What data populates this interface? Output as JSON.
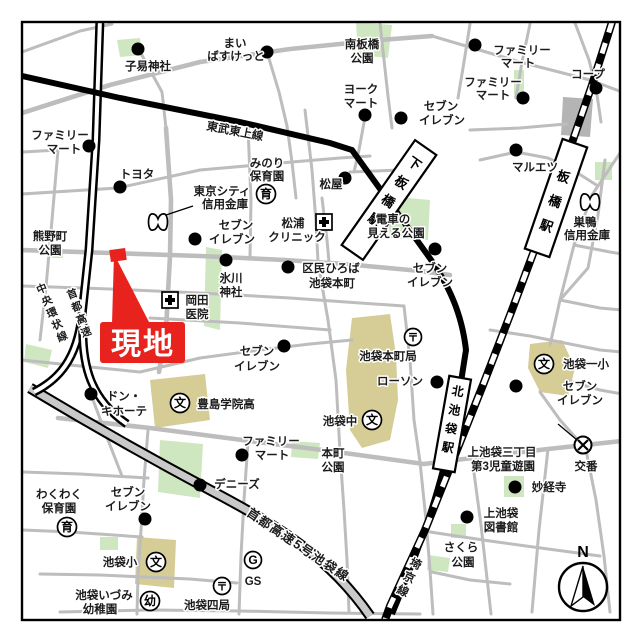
{
  "map": {
    "site_label": "現地",
    "compass_north": "N"
  },
  "railways": {
    "tobu_tojo": "東武東上線",
    "saikyo": "埼京線",
    "shuto5": "首都高速5号池袋線",
    "c2_col1": "首都高速",
    "c2_col2": "中央環状線"
  },
  "stations": {
    "shimo_itabashi": "下板橋駅",
    "itabashi": "板橋駅",
    "kita_ikebukuro": "北池袋駅"
  },
  "icons": {
    "school": "文",
    "nursery": "育",
    "kindergarten": "幼",
    "post_office": "〒",
    "gas": "G"
  },
  "pois": {
    "koyasu": [
      "子易神社"
    ],
    "maibasket": [
      "まい",
      "ばすけっと"
    ],
    "minami_park": [
      "南板橋",
      "公園"
    ],
    "famima_tr1": [
      "ファミリー",
      "マート"
    ],
    "famima_tr2": [
      "ファミリー",
      "マート"
    ],
    "coop": [
      "コープ"
    ],
    "yorkmart": [
      "ヨーク",
      "マート"
    ],
    "seven_york": [
      "セブン",
      "イレブン"
    ],
    "maruetsu": [
      "マルエツ"
    ],
    "famima_tl": [
      "ファミリー",
      "マート"
    ],
    "toyota": [
      "トヨタ"
    ],
    "tokyo_city": [
      "東京シティ",
      "信用金庫"
    ],
    "minori": [
      "みのり",
      "保育園"
    ],
    "matsuya": [
      "松屋"
    ],
    "matsuura": [
      "松浦",
      "クリニック"
    ],
    "seven_center": [
      "セブン",
      "イレブン"
    ],
    "densha_park": [
      "電車の",
      "見える公園"
    ],
    "kumin_hiroba": [
      "区民ひろば",
      "池袋本町"
    ],
    "hikawa": [
      "氷川",
      "神社"
    ],
    "okada": [
      "岡田",
      "医院"
    ],
    "seven_shimo": [
      "セブン",
      "イレブン"
    ],
    "sugamo": [
      "巣鴨",
      "信用金庫"
    ],
    "kumanocho": [
      "熊野町",
      "公園"
    ],
    "seven_genchi": [
      "セブン",
      "イレブン"
    ],
    "donki": [
      "ドン・",
      "キホーテ"
    ],
    "toshima": [
      "豊島学院高"
    ],
    "honcho_po": [
      "池袋本町局"
    ],
    "lawson": [
      "ローソン"
    ],
    "ikebukuro_jhs": [
      "池袋中"
    ],
    "honcho_park": [
      "本町",
      "公園"
    ],
    "ichisho": [
      "池袋一小"
    ],
    "seven_ichisho": [
      "セブン",
      "イレブン"
    ],
    "kami_yuen": [
      "上池袋三丁目",
      "第3児童遊園"
    ],
    "koban": [
      "交番"
    ],
    "myokyoji": [
      "妙経寺"
    ],
    "library": [
      "上池袋",
      "図書館"
    ],
    "sakura": [
      "さくら",
      "公園"
    ],
    "wakuwaku": [
      "わくわく",
      "保育園"
    ],
    "seven_bl": [
      "セブン",
      "イレブン"
    ],
    "dennys": [
      "デニーズ"
    ],
    "famima_c": [
      "ファミリー",
      "マート"
    ],
    "ikebukuro_es": [
      "池袋小"
    ],
    "izumi": [
      "池袋いづみ",
      "幼稚園"
    ],
    "po4": [
      "池袋四局"
    ],
    "gs": [
      "GS"
    ]
  },
  "colors": {
    "site_red": "#e8231e",
    "park_green": "#cfe7c0",
    "school_tan": "#d6cc96",
    "road_gray": "#bdbdbd",
    "building_gray": "#b4b4b4"
  }
}
